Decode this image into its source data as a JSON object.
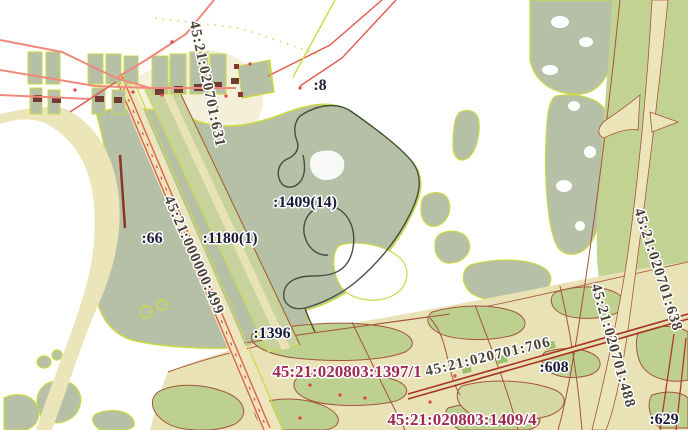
{
  "map": {
    "type": "cadastral-map",
    "colors": {
      "background": "#ffffff",
      "forest_sage": "#b6c0a7",
      "field_tan": "#e9e2b6",
      "road_cream": "#ece5ba",
      "light_green": "#c2d292",
      "olive_patch": "#d4d9a4",
      "boundary_yellow_green": "#ccd944",
      "boundary_brown": "#a2553a",
      "road_pink": "#f0897b",
      "line_red": "#e05a4e",
      "road_dark_red": "#a83428",
      "building_brown": "#703c32",
      "parcel_outline_dark": "#44503f",
      "label_navy": "#1b1b3a",
      "label_red": "#a02a52",
      "label_brown": "#4c4237"
    },
    "labels": {
      "parcels": [
        {
          "text": ":8"
        },
        {
          "text": ":66"
        },
        {
          "text": ":1180(1)"
        },
        {
          "text": ":1409(14)"
        },
        {
          "text": ":1396"
        },
        {
          "text": ":608"
        },
        {
          "text": ":629"
        }
      ],
      "highlighted": [
        {
          "text": "45:21:020803:1397/1"
        },
        {
          "text": "45:21:020803:1409/4"
        }
      ],
      "quarters": [
        {
          "text": "45:21:020701:631"
        },
        {
          "text": "45:21:000000:499"
        },
        {
          "text": "45:21:020701:638"
        },
        {
          "text": "45:21:020701:488"
        },
        {
          "text": "45:21:020701:706"
        }
      ]
    }
  }
}
